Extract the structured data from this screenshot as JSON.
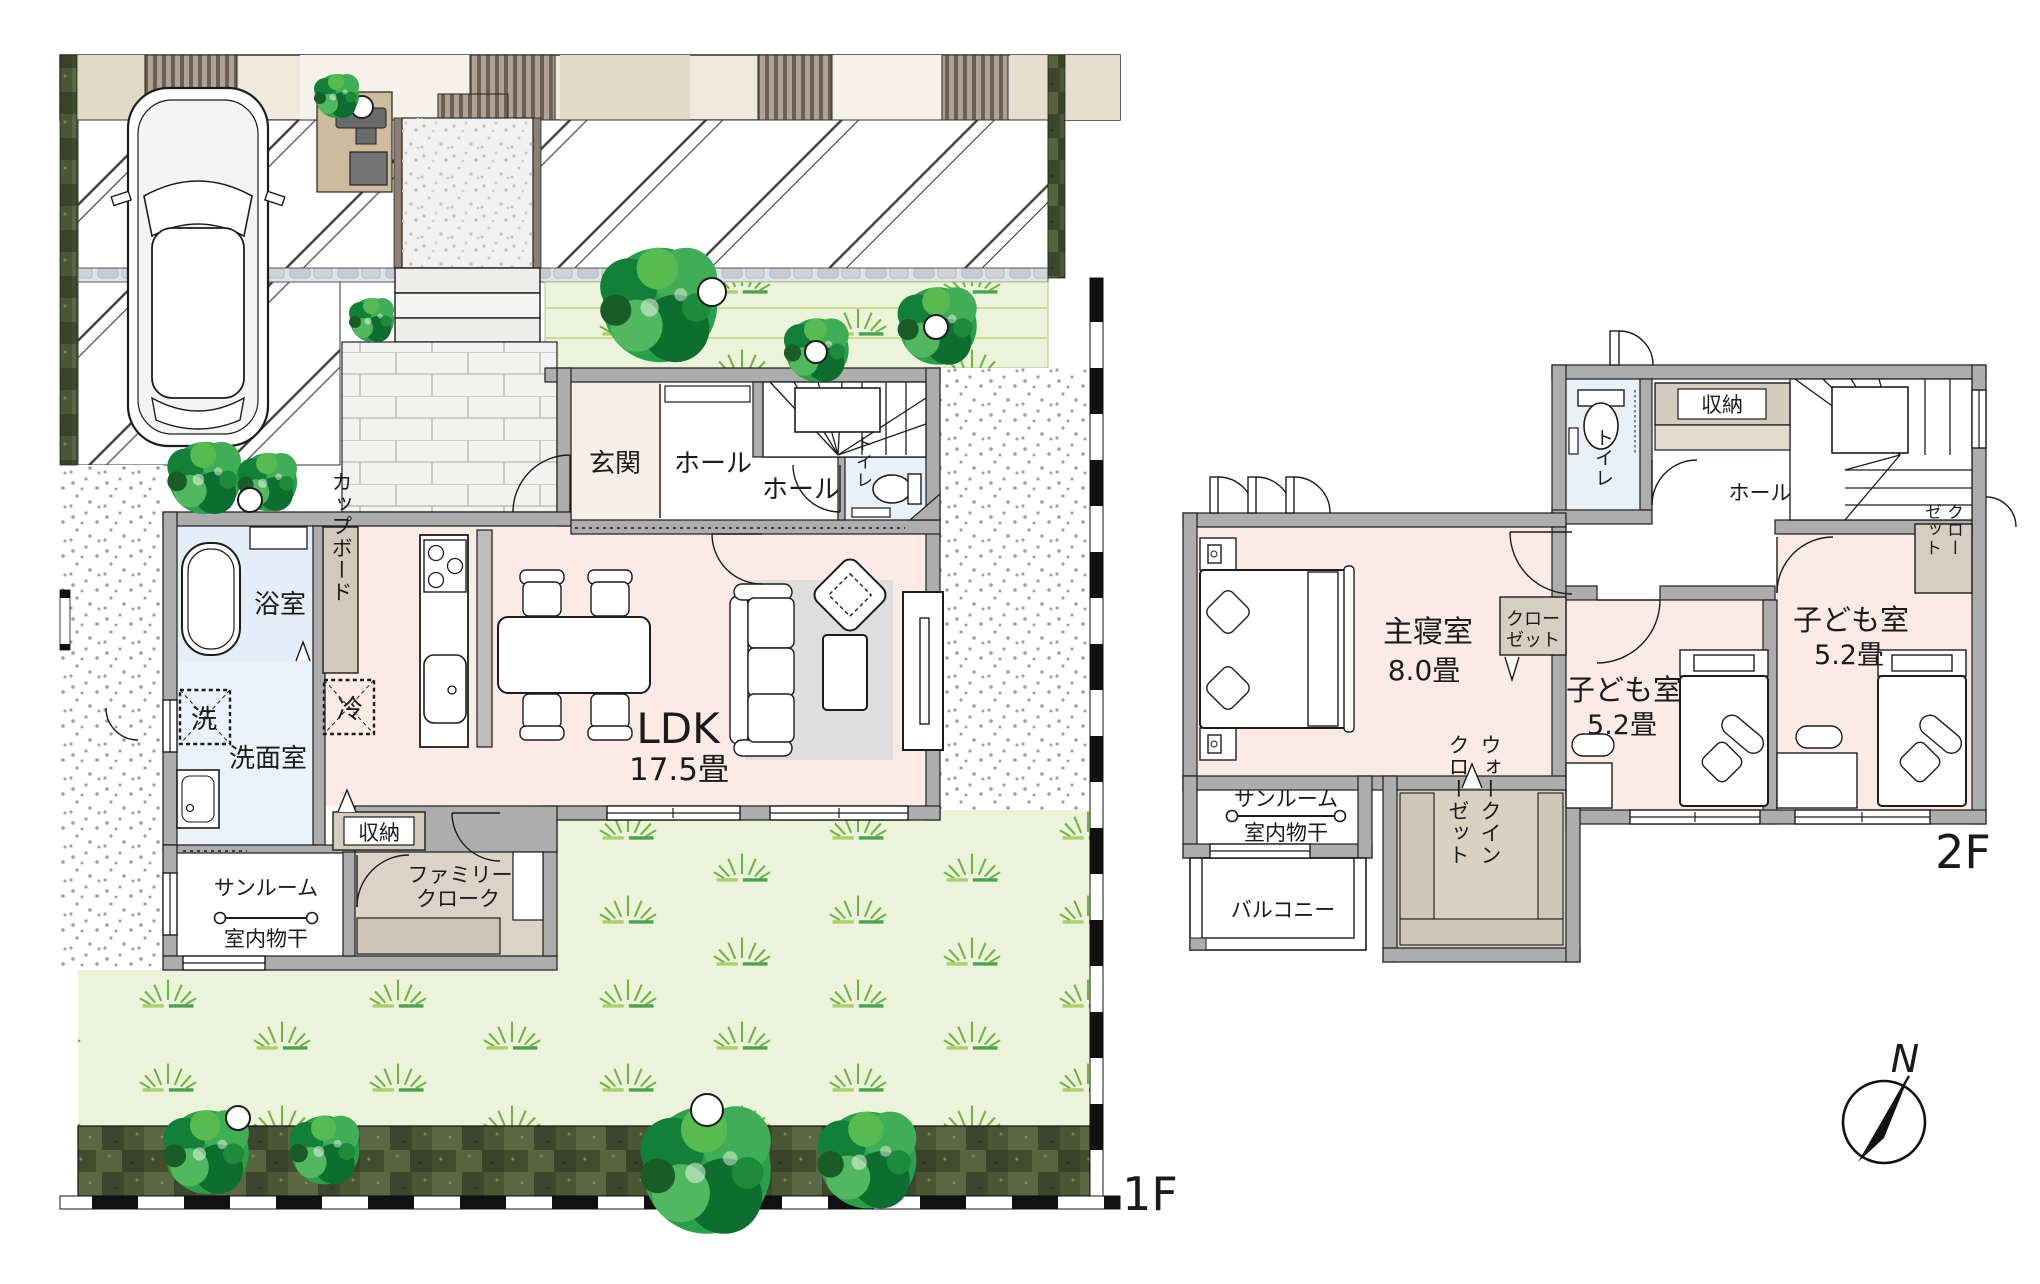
{
  "floor1": {
    "floor_label": "1F",
    "entrance": "玄関",
    "hall": "ホール",
    "hall_small": "ホール",
    "toilet": "トイレ",
    "bathroom": "浴室",
    "washroom": "洗面室",
    "washer": "洗",
    "cupboard": "カップボード",
    "fridge": "冷",
    "ldk_name": "LDK",
    "ldk_size": "17.5畳",
    "storage": "収納",
    "family_cloak_line1": "ファミリー",
    "family_cloak_line2": "クローク",
    "sunroom": "サンルーム",
    "indoor_drying": "室内物干"
  },
  "floor2": {
    "floor_label": "2F",
    "toilet": "トイレ",
    "storage": "収納",
    "hall": "ホール",
    "closet_child_col1": "クロー",
    "closet_child_col2": "ゼット",
    "master_bedroom": "主寝室",
    "master_bedroom_size": "8.0畳",
    "closet_master_line1": "クロー",
    "closet_master_line2": "ゼット",
    "child_room1": "子ども室",
    "child_room1_size": "5.2畳",
    "child_room2": "子ども室",
    "child_room2_size": "5.2畳",
    "sunroom": "サンルーム",
    "indoor_drying": "室内物干",
    "balcony": "バルコニー",
    "wic_col1": "ウォークイン",
    "wic_col2": "クローゼット"
  },
  "compass": {
    "north_label": "N"
  }
}
